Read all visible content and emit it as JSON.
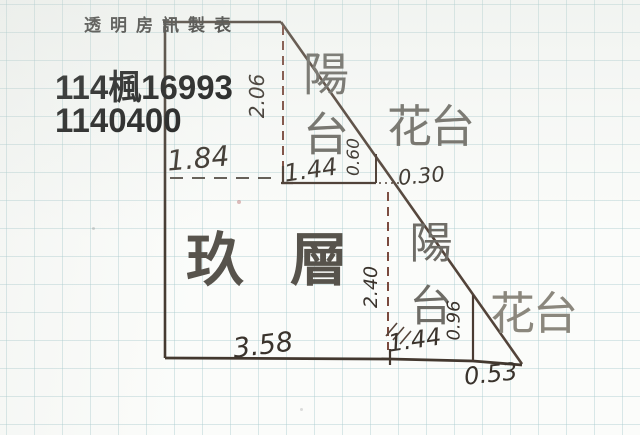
{
  "document": {
    "header_stamp": "透明房訊製表",
    "case_number_line1": "114楓16993",
    "case_number_line2": "1140400"
  },
  "plan": {
    "labels": {
      "balcony_top": "陽台",
      "flower_box_top": "花台",
      "floor_name": "玖層",
      "balcony_right": "陽台",
      "flower_box_bottom": "花台"
    },
    "measurements": {
      "upper_section_width": "1.84",
      "balcony_top_width": "1.44",
      "balcony_top_height": "2.06",
      "flower_top_side": "0.60",
      "flower_top_depth": "0.30",
      "main_room_width": "3.58",
      "main_room_height": "2.40",
      "balcony_right_width": "1.44",
      "flower_bottom_side": "0.96",
      "flower_bottom_width": "0.53"
    }
  },
  "colors": {
    "ink": "#483c34",
    "dashed_line": "#7b4a3e",
    "grid": "#a8cbce",
    "kanji_gray": "#6e6c66"
  }
}
